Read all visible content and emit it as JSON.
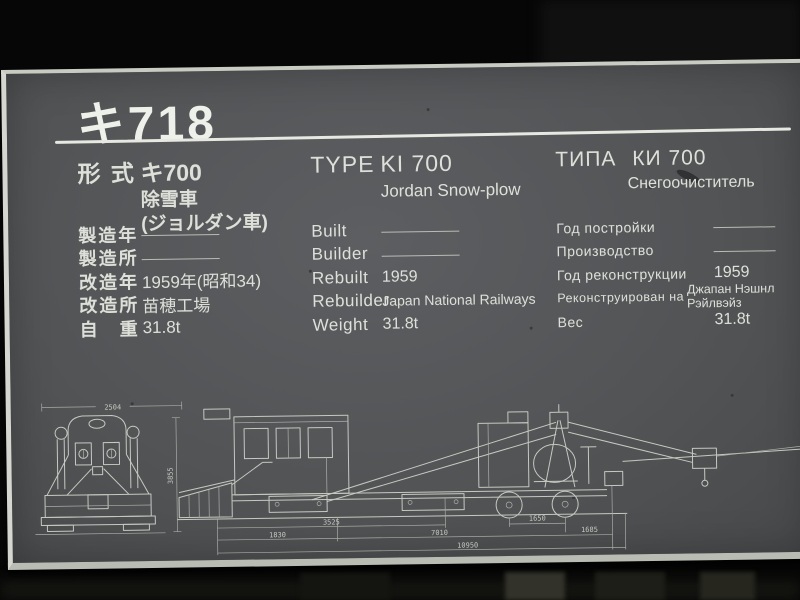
{
  "plaque": {
    "title": "キ718",
    "columns": [
      {
        "id": "japanese",
        "heading_label": "形 式",
        "heading_value": "キ700",
        "heading_sub": [
          "除雪車",
          "(ジョルダン車)"
        ],
        "rows": [
          {
            "label": "製造年",
            "value": ""
          },
          {
            "label": "製造所",
            "value": ""
          },
          {
            "label": "改造年",
            "value": "1959年(昭和34)"
          },
          {
            "label": "改造所",
            "value": "苗穂工場"
          },
          {
            "label": "自　重",
            "value": "31.8t"
          }
        ]
      },
      {
        "id": "english",
        "heading_label": "TYPE",
        "heading_value": "KI 700",
        "heading_sub": [
          "Jordan Snow-plow"
        ],
        "rows": [
          {
            "label": "Built",
            "value": ""
          },
          {
            "label": "Builder",
            "value": ""
          },
          {
            "label": "Rebuilt",
            "value": "1959"
          },
          {
            "label": "Rebuilder",
            "value": "Japan National Railways"
          },
          {
            "label": "Weight",
            "value": "31.8t"
          }
        ]
      },
      {
        "id": "russian",
        "heading_label": "ТИПА",
        "heading_value": "КИ 700",
        "heading_sub": [
          "Снегоочиститель"
        ],
        "rows": [
          {
            "label": "Год постройки",
            "value": ""
          },
          {
            "label": "Производство",
            "value": ""
          },
          {
            "label": "Год реконструкции",
            "value": "1959"
          },
          {
            "label": "Реконструирован на",
            "value": "Джапан Нэшнл Рэйлвэйз"
          },
          {
            "label": "Вес",
            "value": "31.8t"
          }
        ]
      }
    ],
    "drawings": {
      "front_view": {
        "width_dim": "2504",
        "height_dim": "3855"
      },
      "side_view": {
        "dims": [
          "1830",
          "3525",
          "7010",
          "1650",
          "1685",
          "10950"
        ]
      }
    },
    "colors": {
      "plate": "#525456",
      "edge": "#c8cbc2",
      "text": "#dde0d8",
      "background": "#060606"
    }
  }
}
